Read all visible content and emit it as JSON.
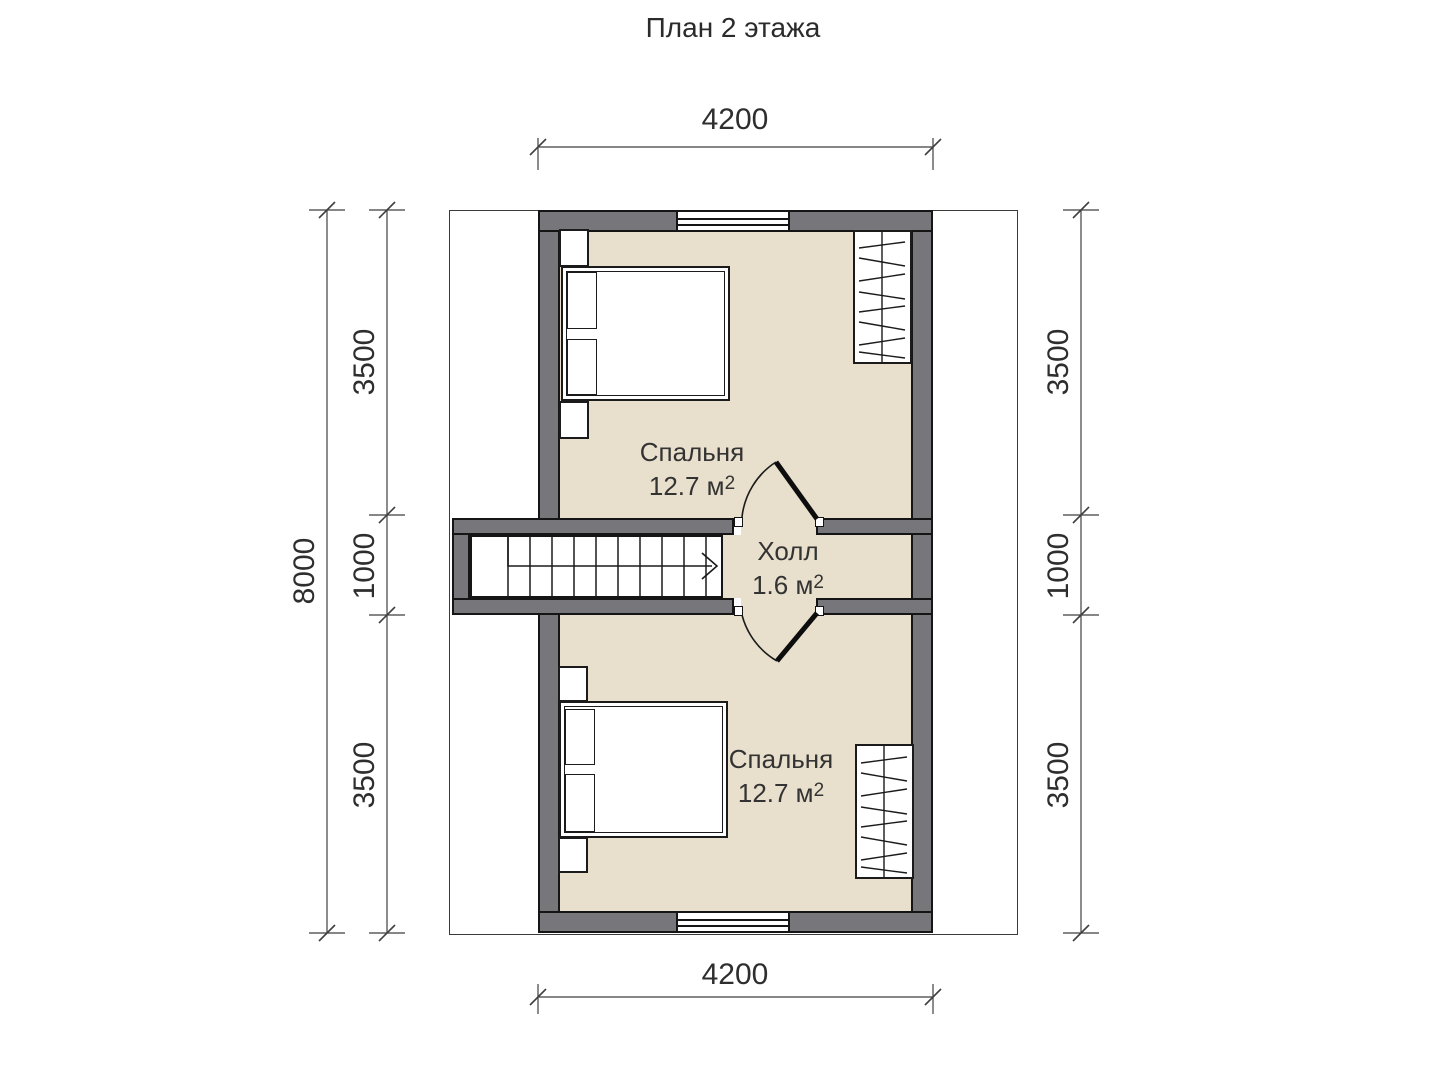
{
  "title": "План 2 этажа",
  "dimensions": {
    "top": "4200",
    "bottom": "4200",
    "left_total": "8000",
    "left_segments": [
      "3500",
      "1000",
      "3500"
    ],
    "right_segments": [
      "3500",
      "1000",
      "3500"
    ]
  },
  "rooms": {
    "bedroom_top": {
      "name": "Спальня",
      "area_value": "12.7 м",
      "area_sup": "2"
    },
    "hall": {
      "name": "Холл",
      "area_value": "1.6 м",
      "area_sup": "2"
    },
    "bedroom_bottom": {
      "name": "Спальня",
      "area_value": "12.7 м",
      "area_sup": "2"
    }
  },
  "colors": {
    "wall": "#77777b",
    "floor": "#e8e0cc",
    "outline": "#1b1b1b"
  }
}
